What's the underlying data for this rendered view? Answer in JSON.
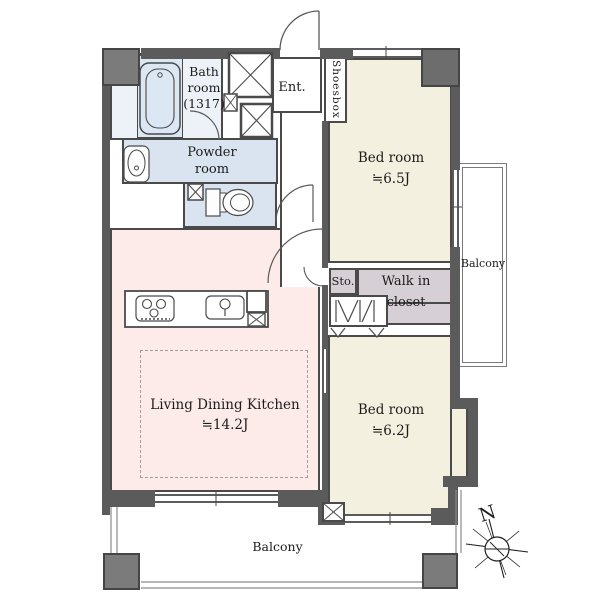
{
  "plan_title": "apartment-floor-plan",
  "colors": {
    "wall": "#5b5b5b",
    "pillar": "#7b7b7b",
    "bedroom_floor": "#f4f0df",
    "ldk_floor": "#fcebe8",
    "wet_area_floor": "#d9e4f0",
    "closet_floor": "#d6cfd5",
    "line": "#4a4a4a"
  },
  "rooms": {
    "bath": {
      "line1": "Bath",
      "line2": "room",
      "line3": "(1317)"
    },
    "powder": {
      "line1": "Powder",
      "line2": "room"
    },
    "entrance": {
      "label": "Ent."
    },
    "shoesbox": {
      "label": "Shoesbox"
    },
    "bedroom1": {
      "line1": "Bed room",
      "line2": "≒6.5J"
    },
    "bedroom2": {
      "line1": "Bed room",
      "line2": "≒6.2J"
    },
    "ldk": {
      "line1": "Living Dining Kitchen",
      "line2": "≒14.2J"
    },
    "storage": {
      "label": "Sto."
    },
    "walk_in_closet": {
      "line1": "Walk in",
      "line2": "closet"
    },
    "balcony_right": {
      "label": "Balcony"
    },
    "balcony_bottom": {
      "label": "Balcony"
    }
  },
  "compass": {
    "north_label": "N"
  }
}
